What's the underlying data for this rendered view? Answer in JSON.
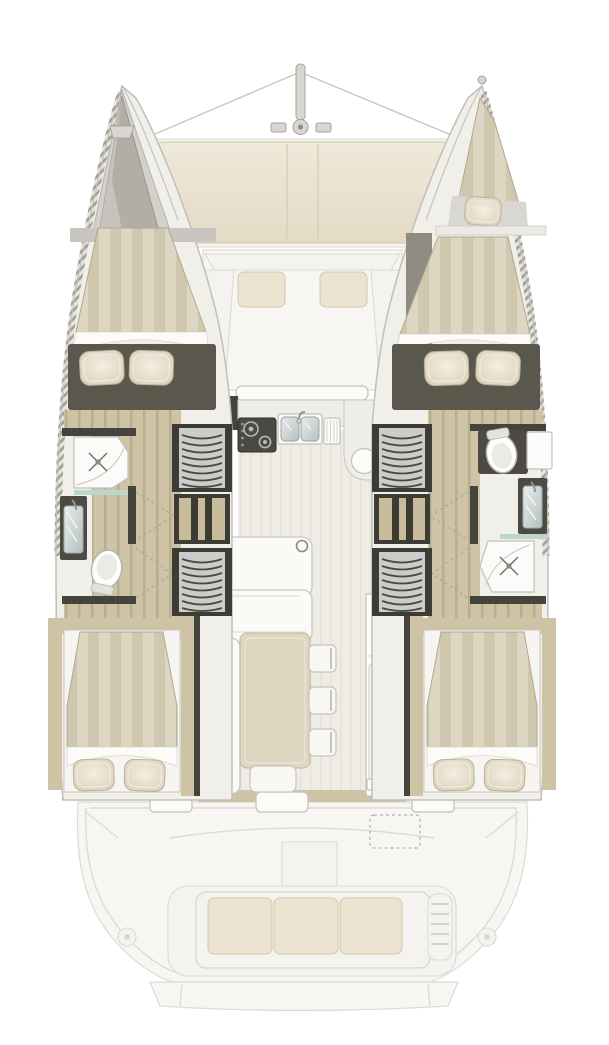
{
  "meta": {
    "title": "Catamaran interior deck plan"
  },
  "colors": {
    "background": "#ffffff",
    "outline": "#c2bfb9",
    "outline_soft": "#dddbd5",
    "deck": "#f7f6f3",
    "cream": "#ece4d1",
    "wood": "#cec3a4",
    "wood_stripe": "#b9ae90",
    "duvet": "#ddd6c2",
    "duvet_stripe": "#cfc7ae",
    "wall_dark": "#45443c",
    "wall_mid": "#5a574d",
    "gray_locker": "#b2aea6",
    "stair_face": "#cbcdca",
    "stair_arc": "#4a493f",
    "shelf_wood": "#c8bc9d",
    "white_fixture": "#fbfbf9",
    "glass": "#bcd8cd",
    "table": "#ded6c0"
  },
  "regions": {
    "foredeck": [
      "mast",
      "rigging",
      "sunpads",
      "forward-cockpit-seating"
    ],
    "port_hull": [
      "anchor-locker",
      "forward-berth",
      "shower",
      "washbasin",
      "toilet",
      "companionway-stairs-forward",
      "shelf-unit",
      "companionway-stairs-aft",
      "aft-berth"
    ],
    "starboard_hull": [
      "bow-berth",
      "forward-berth",
      "toilet",
      "washbasin",
      "shower",
      "companionway-stairs-forward",
      "shelf-unit",
      "companionway-stairs-aft",
      "aft-berth"
    ],
    "saloon": [
      "galley-stove",
      "galley-double-sink",
      "drainboard",
      "l-counter",
      "chart-cabinet",
      "l-sofa",
      "dining-table",
      "dining-chairs",
      "stool"
    ],
    "cockpit": [
      "aft-bench-seat",
      "helm-pod",
      "winches",
      "transom-platform"
    ]
  },
  "counts": {
    "double_berths": 4,
    "bow_berths": 1,
    "bathrooms": 2,
    "pillows": 9,
    "dining_chairs": 3,
    "cockpit_bench_cushions": 3,
    "stove_burners": 2,
    "sink_basins": 2,
    "stair_flights": 4
  }
}
